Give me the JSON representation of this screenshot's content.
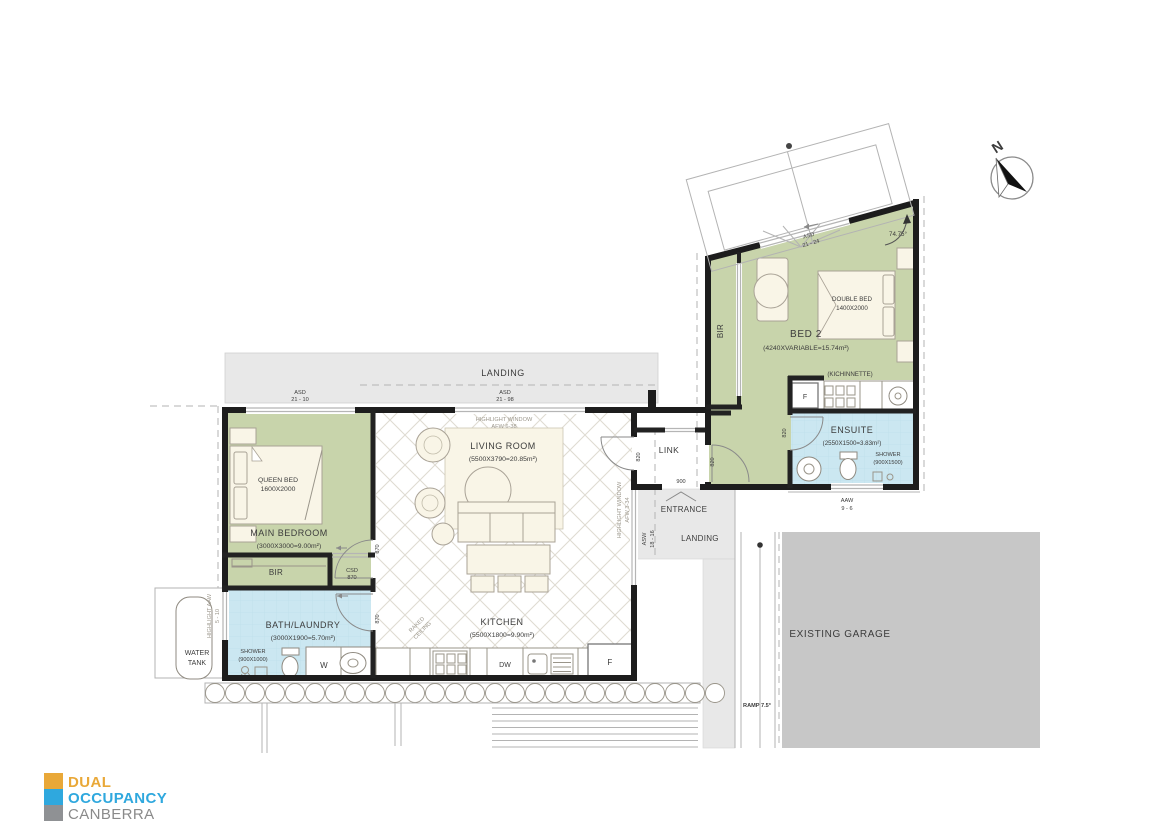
{
  "colors": {
    "room_green": "#c8d4ab",
    "wet_area_blue": "#cbe7f1",
    "landing_gray": "#e8e8e8",
    "garage_gray": "#c7c7c7",
    "wall_black": "#1d1d1d",
    "logo_gold": "#E9A838",
    "logo_blue": "#2FA8DE",
    "logo_gray": "#8F9194"
  },
  "compass": {
    "north": "N"
  },
  "site": {
    "landing_top": "LANDING",
    "landing_entry": "LANDING",
    "entrance": "ENTRANCE",
    "door_900": "900",
    "ramp": "RAMP 7.5°",
    "garage": "EXISTING GARAGE",
    "water_tank_1": "WATER",
    "water_tank_2": "TANK"
  },
  "rooms": {
    "living": {
      "name": "LIVING ROOM",
      "dims": "(5500X3790=20.85m²)",
      "raked_1": "RAKED",
      "raked_2": "CEILING"
    },
    "kitchen": {
      "name": "KITCHEN",
      "dims": "(5500X1800=9.90m²)",
      "dishwasher": "DW",
      "fridge": "F"
    },
    "main_bedroom": {
      "name": "MAIN BEDROOM",
      "dims": "(3000X3000=9.00m²)",
      "bed_1": "QUEEN BED",
      "bed_2": "1600X2000",
      "robe": "BIR"
    },
    "bath": {
      "name": "BATH/LAUNDRY",
      "dims": "(3000X1900=5.70m²)",
      "shower_1": "SHOWER",
      "shower_2": "(900X1000)",
      "washer": "W"
    },
    "link": {
      "name": "LINK"
    },
    "bed2": {
      "name": "BED 2",
      "dims": "(4240XVARIABLE=15.74m²)",
      "bed_1": "DOUBLE BED",
      "bed_2": "1400X2000",
      "robe": "BIR",
      "kitchenette": "(KICHINNETTE)",
      "fridge": "F"
    },
    "ensuite": {
      "name": "ENSUITE",
      "dims": "(2550X1500=3.83m²)",
      "shower_1": "SHOWER",
      "shower_2": "(900X1500)"
    }
  },
  "openings": {
    "asd_main_1": "ASD",
    "asd_main_2": "21 - 10",
    "asd_living_1": "ASD",
    "asd_living_2": "21 - 98",
    "afw_top_1": "HIGHLIGHT WINDOW",
    "afw_top_2": "AFW 6-38",
    "afw_side_1": "HIGHLIGHT WINDOW",
    "afw_side_2": "AFW 3-34",
    "asw_side_1": "ASW",
    "asw_side_2": "18 - 16",
    "aaw_left_1": "HIGHLIGHT AAW",
    "aaw_left_2": "5 - 10",
    "aaw_ensuite_1": "AAW",
    "aaw_ensuite_2": "9 - 6",
    "asd_bed2_1": "ASD",
    "asd_bed2_2": "21 - 24",
    "csd_1": "CSD",
    "csd_2": "870",
    "door_870_a": "870",
    "door_870_b": "870",
    "door_820_a": "820",
    "door_820_b": "820",
    "door_820_c": "820",
    "wall_angle": "74.75°"
  },
  "logo": {
    "line_1": "DUAL",
    "line_2": "OCCUPANCY",
    "line_3": "CANBERRA"
  }
}
